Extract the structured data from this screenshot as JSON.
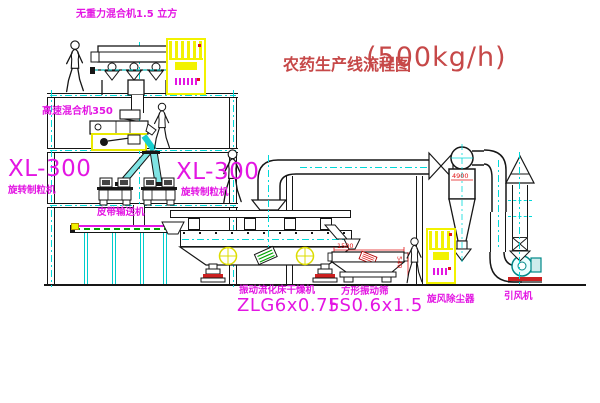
{
  "title": {
    "name": "农药生产线流程图",
    "capacity": "(500kg/h)"
  },
  "labels": {
    "gravity_mixer": "无重力混合机1.5 立方",
    "high_speed_mixer": "高速混合机350",
    "granulator_left_model": "XL-300",
    "granulator_left_name": "旋转制粒机",
    "granulator_right_model": "XL-300",
    "granulator_right_name": "旋转制粒机",
    "belt_conveyor": "皮带输送机",
    "dryer_name": "振动流化床干燥机",
    "dryer_model": "ZLG6x0.75",
    "sieve_name": "方形振动筛",
    "sieve_model": "FS0.6x1.5",
    "cyclone": "旋风除尘器",
    "fan": "引风机"
  },
  "dimensions": {
    "sieve_length": "1500",
    "sieve_height": "540",
    "cyclone_note": "4900"
  },
  "figures": {
    "worker_count": 4
  },
  "colors": {
    "label_magenta": "#e316e3",
    "title_red": "#c64848",
    "dimension_red": "#e01414",
    "line_black": "#161616",
    "centerline_cyan": "#00d9d9",
    "cabinet_yellow": "#f2f200",
    "dryer_circle_yellow": "#dcdc00",
    "conveyor_green": "#00a400",
    "background": "#ffffff"
  }
}
